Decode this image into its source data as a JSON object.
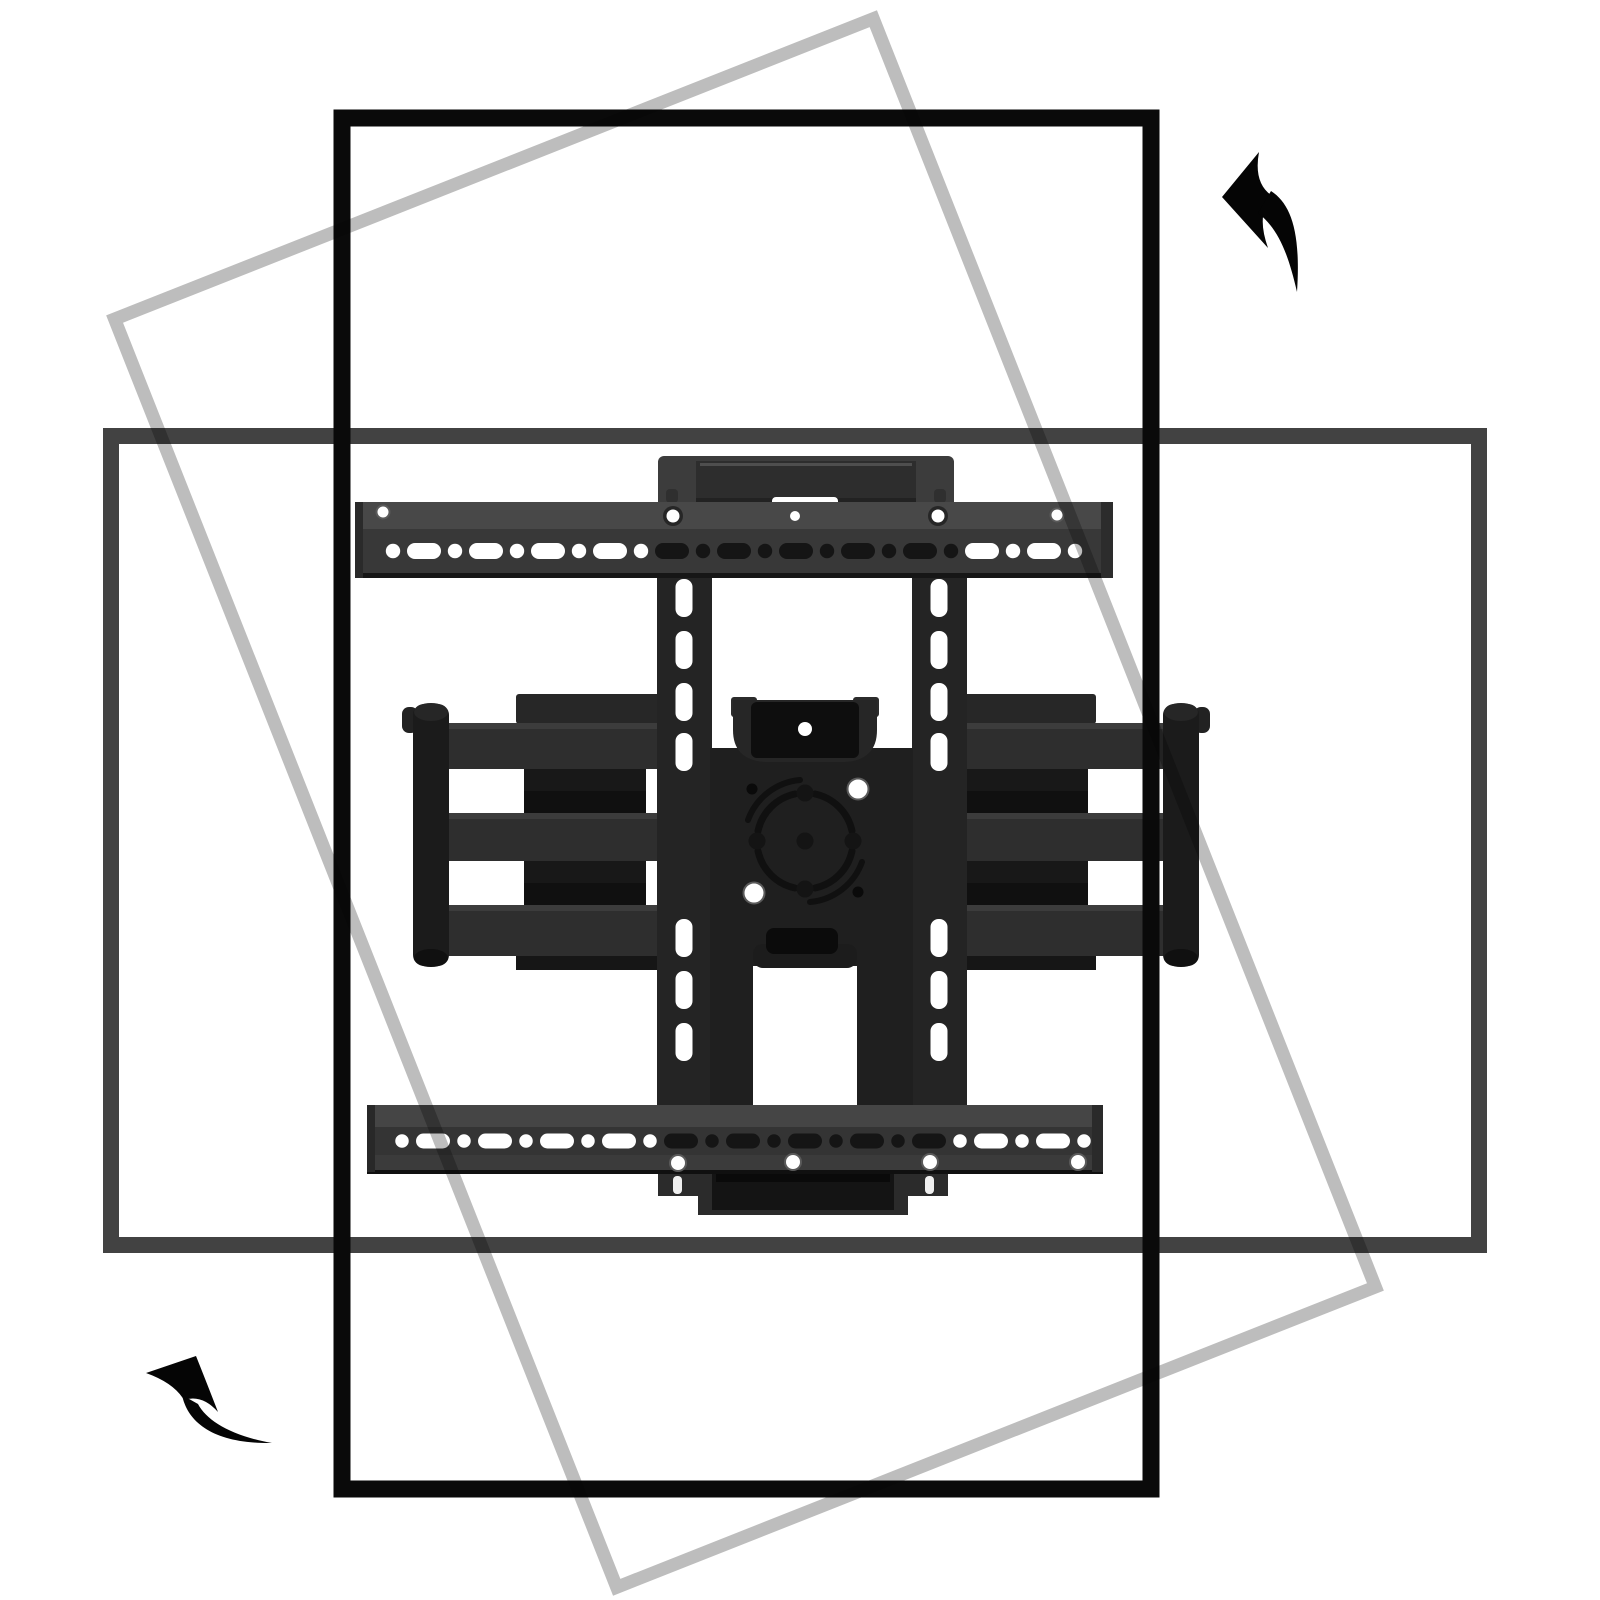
{
  "scene": {
    "title": "TV wall mount rotation diagram",
    "background": "#ffffff",
    "description": "Full-motion articulating TV wall mount shown between a portrait TV outline and a landscape TV outline, with curved arrows indicating counterclockwise screen rotation"
  },
  "outlines": {
    "portrait": {
      "name": "TV outline portrait orientation",
      "stroke": "#0a0a0a"
    },
    "landscape": {
      "name": "TV outline landscape orientation",
      "stroke": "#424242"
    },
    "rotating": {
      "name": "TV outline mid-rotation (tilted)",
      "stroke": "#bdbdbd"
    }
  },
  "arrows": {
    "color": "#050505",
    "top_right": {
      "name": "rotate-counterclockwise-arrow"
    },
    "bottom_left": {
      "name": "rotate-counterclockwise-arrow"
    }
  },
  "mount": {
    "name": "Full-motion articulating TV wall mount",
    "colors": {
      "rail_flange": "#484848",
      "rail_face": "#383838",
      "rail_edge": "#161616",
      "bottom_rail_flange": "#454545",
      "bottom_rail_face": "#343434",
      "bottom_rail_lower": "#3b3b3b",
      "bracket": "#3c3c3c",
      "bracket_recess": "#2d2d2d",
      "band": "#242424",
      "plate": "#1f1f1f",
      "cup": "#262626",
      "cup_inner": "#0e0e0e",
      "clamp": "#0b0b0b",
      "clamp_base": "#1c1c1c",
      "arm_bar": "#2e2e2e",
      "arm_bar_edge": "#3c3c3c",
      "arm_connector": "#181818",
      "arm_connector_shadow": "#101010",
      "arm_cap": "#1b1b1b",
      "arm_rear": "#272727",
      "arm_rear_low": "#161616",
      "bottom_bracket": "#2b2b2b",
      "bottom_bracket_recess": "#141414",
      "slot_light": "#ffffff",
      "slot_dark": "#151515",
      "hole_ring": "#5a5a5a",
      "dial": "#141414",
      "dial_arc": "#101010"
    }
  }
}
